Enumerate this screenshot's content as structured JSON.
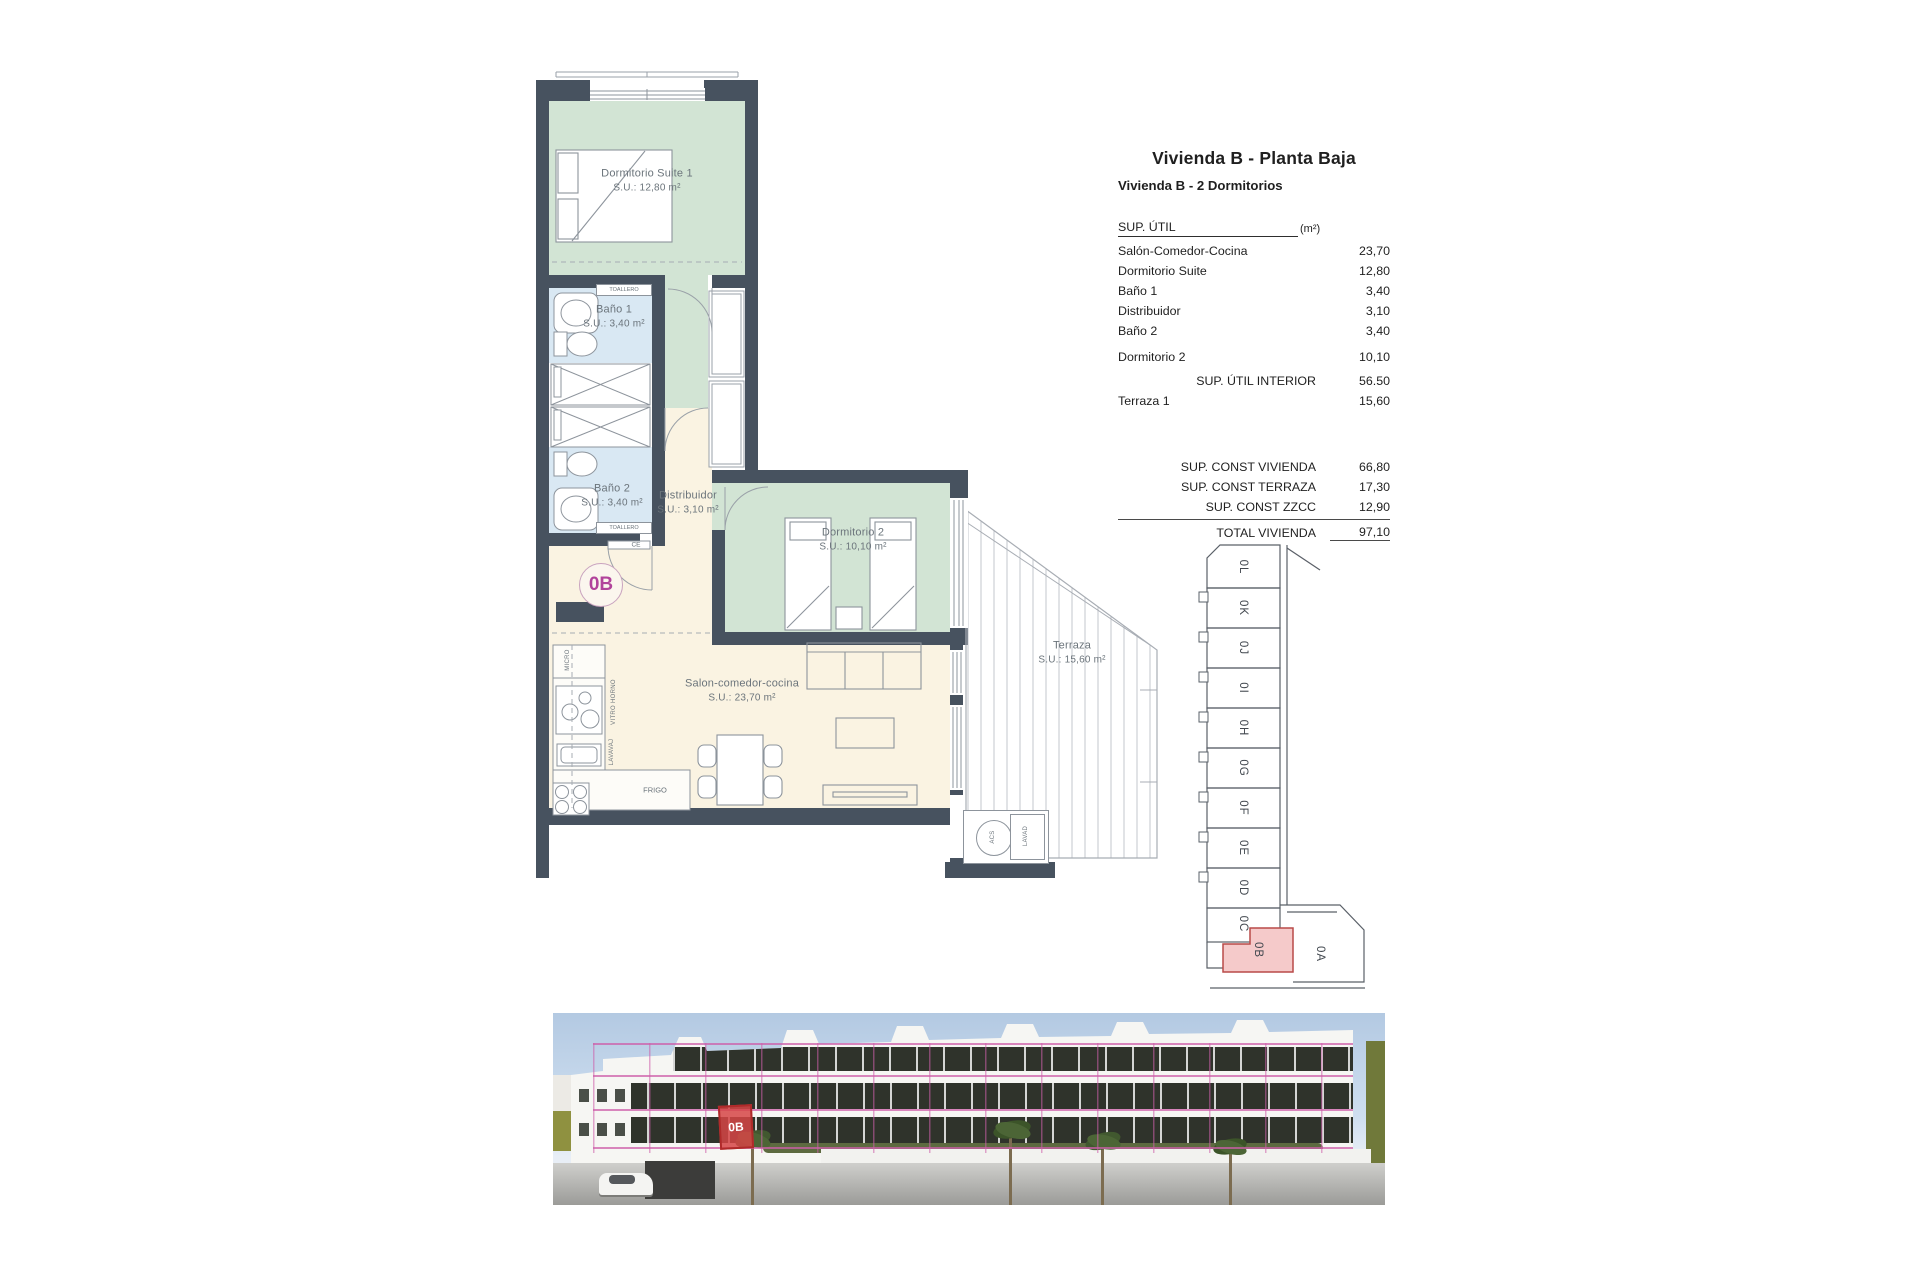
{
  "info": {
    "title": "Vivienda B - Planta Baja",
    "subtitle": "Vivienda B - 2 Dormitorios",
    "header": {
      "label": "SUP. ÚTIL",
      "unit": "(m²)"
    },
    "rows": [
      {
        "label": "Salón-Comedor-Cocina",
        "value": "23,70"
      },
      {
        "label": "Dormitorio Suite",
        "value": "12,80"
      },
      {
        "label": "Baño 1",
        "value": "3,40"
      },
      {
        "label": "Distribuidor",
        "value": "3,10"
      },
      {
        "label": "Baño 2",
        "value": "3,40"
      },
      {
        "label": "Dormitorio 2",
        "value": "10,10"
      }
    ],
    "subtotal": {
      "label": "SUP. ÚTIL INTERIOR",
      "value": "56.50"
    },
    "terraza_row": {
      "label": "Terraza 1",
      "value": "15,60"
    },
    "const_rows": [
      {
        "label": "SUP. CONST VIVIENDA",
        "value": "66,80"
      },
      {
        "label": "SUP. CONST TERRAZA",
        "value": "17,30"
      },
      {
        "label": "SUP. CONST ZZCC",
        "value": "12,90"
      }
    ],
    "total": {
      "label": "TOTAL VIVIENDA",
      "value": "97,10"
    }
  },
  "plan": {
    "unit_badge": "0B",
    "rooms": {
      "suite": {
        "name": "Dormitorio Suite 1",
        "area": "S.U.: 12,80 m²"
      },
      "bano1": {
        "name": "Baño 1",
        "area": "S.U.: 3,40 m²"
      },
      "bano2": {
        "name": "Baño 2",
        "area": "S.U.: 3,40 m²"
      },
      "distribuidor": {
        "name": "Distribuidor",
        "area": "S.U.: 3,10 m²"
      },
      "dorm2": {
        "name": "Dormitorio 2",
        "area": "S.U.: 10,10 m²"
      },
      "salon": {
        "name": "Salon-comedor-cocina",
        "area": "S.U.: 23,70 m²"
      },
      "terraza": {
        "name": "Terraza",
        "area": "S.U.: 15,60 m²"
      }
    },
    "fixtures": {
      "toallero": "TOALLERO",
      "micro": "MICRO",
      "vitro_horno": "VITRO HORNO",
      "lavavaj": "LAVAVAJ",
      "frigo": "FRIGO",
      "acs": "ACS",
      "lavad": "LAVAD",
      "ce": "CE"
    }
  },
  "key_plan": {
    "units": [
      "0L",
      "0K",
      "0J",
      "0I",
      "0H",
      "0G",
      "0F",
      "0E",
      "0D",
      "0C"
    ],
    "highlight_unit": "0B",
    "adjacent_unit": "0A"
  },
  "photo": {
    "badge_label": "0B"
  },
  "colors": {
    "wall": "#47525f",
    "room_green": "#d2e4d4",
    "room_blue": "#d9e8f3",
    "room_cream": "#faf3e2",
    "accent_pink": "#b1439b",
    "keyplan_highlight_fill": "#f5caca",
    "keyplan_highlight_stroke": "#b94a48",
    "photo_grid_pink": "#cd5faa",
    "photo_badge_red": "#cc3333"
  }
}
